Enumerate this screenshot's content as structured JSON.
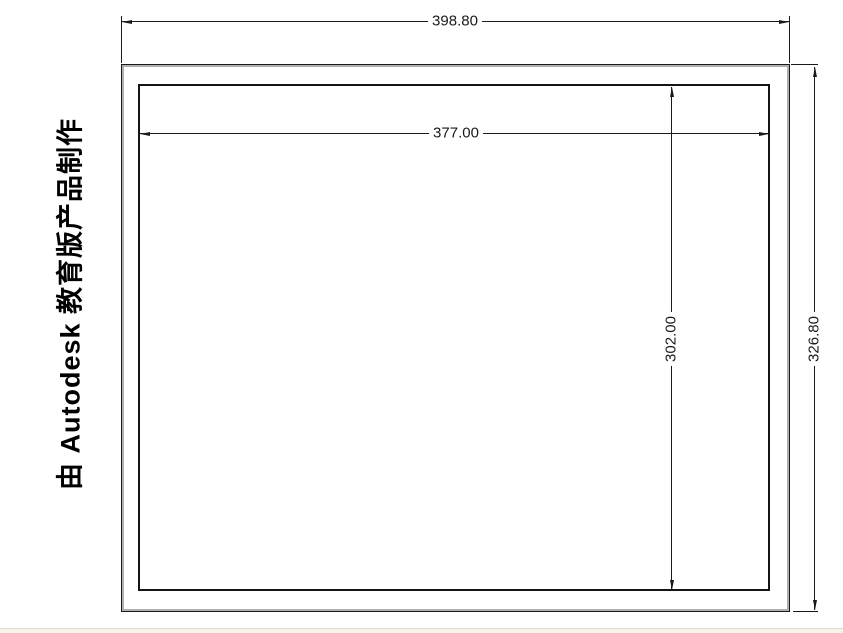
{
  "watermark": {
    "text": "由 Autodesk 教育版产品制作"
  },
  "drawing": {
    "type": "cad-dimensioned-rectangles",
    "dimensions": {
      "outer_width": {
        "value": "398.80",
        "orientation": "horizontal",
        "target": "outer-rectangle-width"
      },
      "inner_width": {
        "value": "377.00",
        "orientation": "horizontal",
        "target": "inner-rectangle-width"
      },
      "inner_height": {
        "value": "302.00",
        "orientation": "vertical",
        "target": "inner-rectangle-height"
      },
      "outer_height": {
        "value": "326.80",
        "orientation": "vertical",
        "target": "outer-rectangle-height"
      }
    }
  },
  "colors": {
    "line": "#1a1a1a",
    "paper": "#ffffff",
    "watermark_text": "#000000",
    "outer_rect_shadow": "#b0b0b0",
    "bottom_strip": "#f6f3ea"
  }
}
